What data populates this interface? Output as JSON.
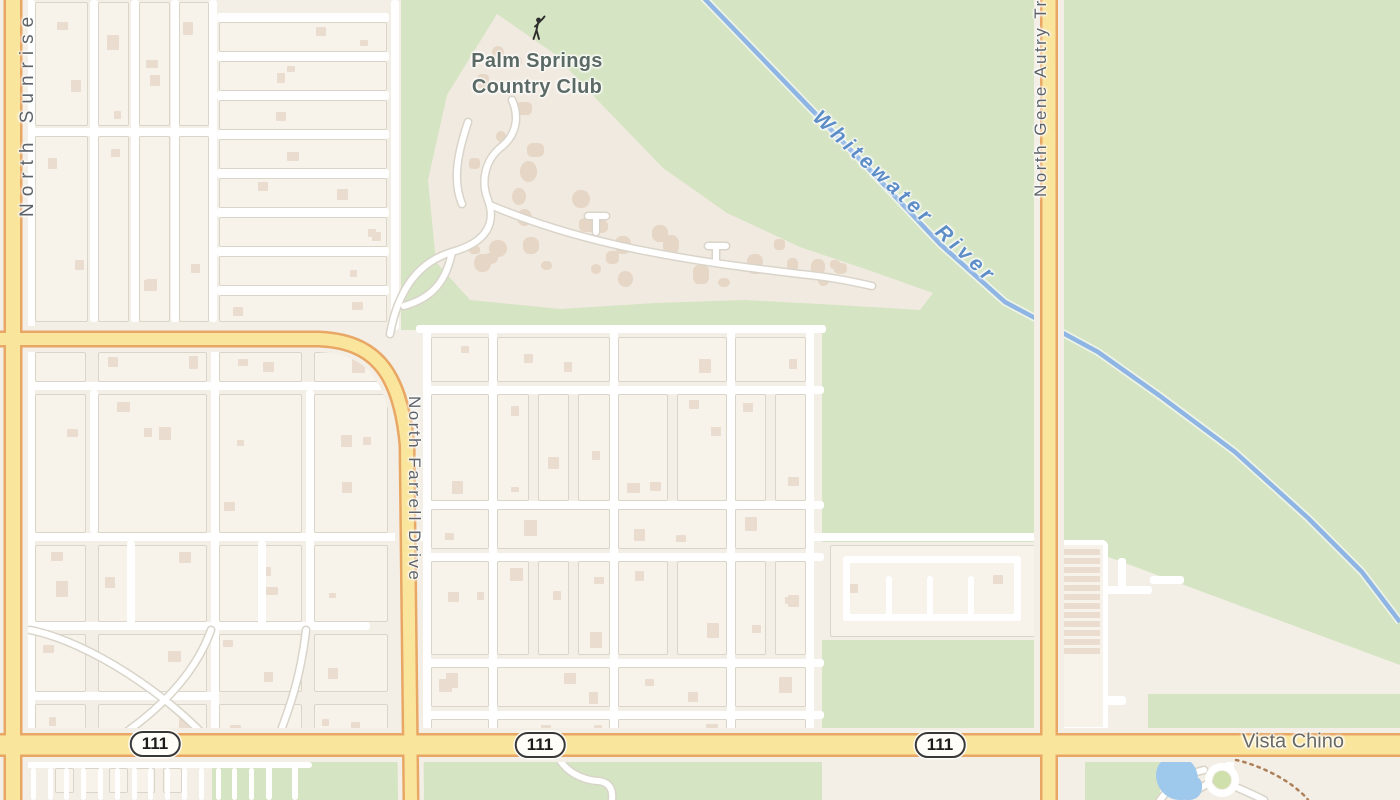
{
  "map": {
    "poi": {
      "country_club_line1": "Palm Springs",
      "country_club_line2": "Country Club"
    },
    "roads": {
      "sunrise": "North Sunrise Way",
      "farrell": "North Farrell Drive",
      "gene_autry": "North Gene Autry Trail",
      "vista_chino": "Vista Chino"
    },
    "water": {
      "river": "Whitewater River"
    },
    "shields": [
      "111",
      "111",
      "111"
    ],
    "icons": [
      "golfer-icon"
    ],
    "colors": {
      "road_fill": "#fae59c",
      "road_casing": "#e9a765",
      "green_area": "#d5e4c2",
      "water_line": "#8fb5e5",
      "pond_fill": "#9ec8ec",
      "base_beige": "#f3efe6",
      "label_gray": "#5d6368",
      "river_label_blue": "#5d8dc7"
    }
  }
}
